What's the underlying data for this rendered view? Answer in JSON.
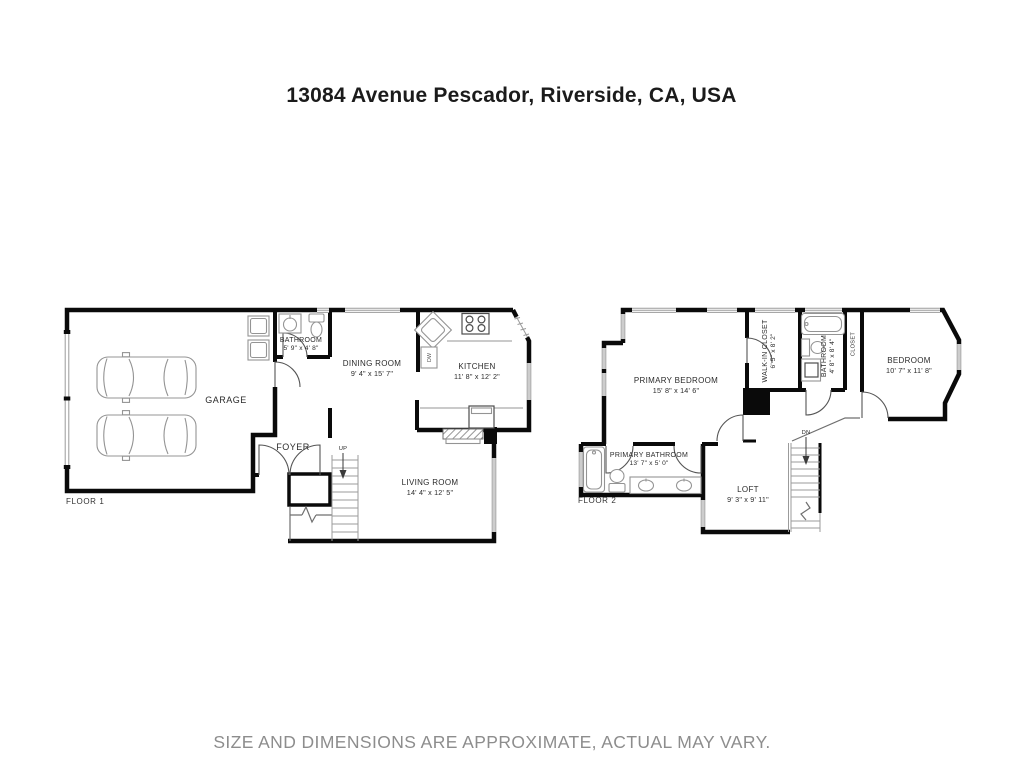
{
  "address_title": "13084 Avenue Pescador, Riverside, CA, USA",
  "disclaimer": "SIZE AND DIMENSIONS ARE APPROXIMATE, ACTUAL MAY VARY.",
  "colors": {
    "wall": "#0a0a0a",
    "fixture_line": "#949494",
    "label_text": "#2b2b2b",
    "disclaimer_text": "#8d8d8d"
  },
  "floor1": {
    "label": "FLOOR 1",
    "stairs_direction": "UP",
    "dishwasher_label": "DW",
    "rooms": {
      "garage": {
        "name": "GARAGE"
      },
      "bathroom": {
        "name": "BATHROOM",
        "dims": "5' 9\" x 4' 8\""
      },
      "dining_room": {
        "name": "DINING ROOM",
        "dims": "9' 4\" x 15' 7\""
      },
      "kitchen": {
        "name": "KITCHEN",
        "dims": "11' 8\" x 12' 2\""
      },
      "foyer": {
        "name": "FOYER"
      },
      "living_room": {
        "name": "LIVING ROOM",
        "dims": "14' 4\" x 12' 5\""
      }
    }
  },
  "floor2": {
    "label": "FLOOR 2",
    "stairs_direction": "DN",
    "rooms": {
      "primary_bedroom": {
        "name": "PRIMARY BEDROOM",
        "dims": "15' 8\" x 14' 6\""
      },
      "walk_in_closet": {
        "name": "WALK-IN CLOSET",
        "dims": "6' 5\" x 8' 2\""
      },
      "bathroom": {
        "name": "BATHROOM",
        "dims": "4' 8\" x 8' 4\""
      },
      "closet": {
        "name": "CLOSET"
      },
      "bedroom": {
        "name": "BEDROOM",
        "dims": "10' 7\" x 11' 8\""
      },
      "primary_bathroom": {
        "name": "PRIMARY BATHROOM",
        "dims": "13' 7\" x 5' 0\""
      },
      "loft": {
        "name": "LOFT",
        "dims": "9' 3\" x 9' 11\""
      }
    }
  }
}
